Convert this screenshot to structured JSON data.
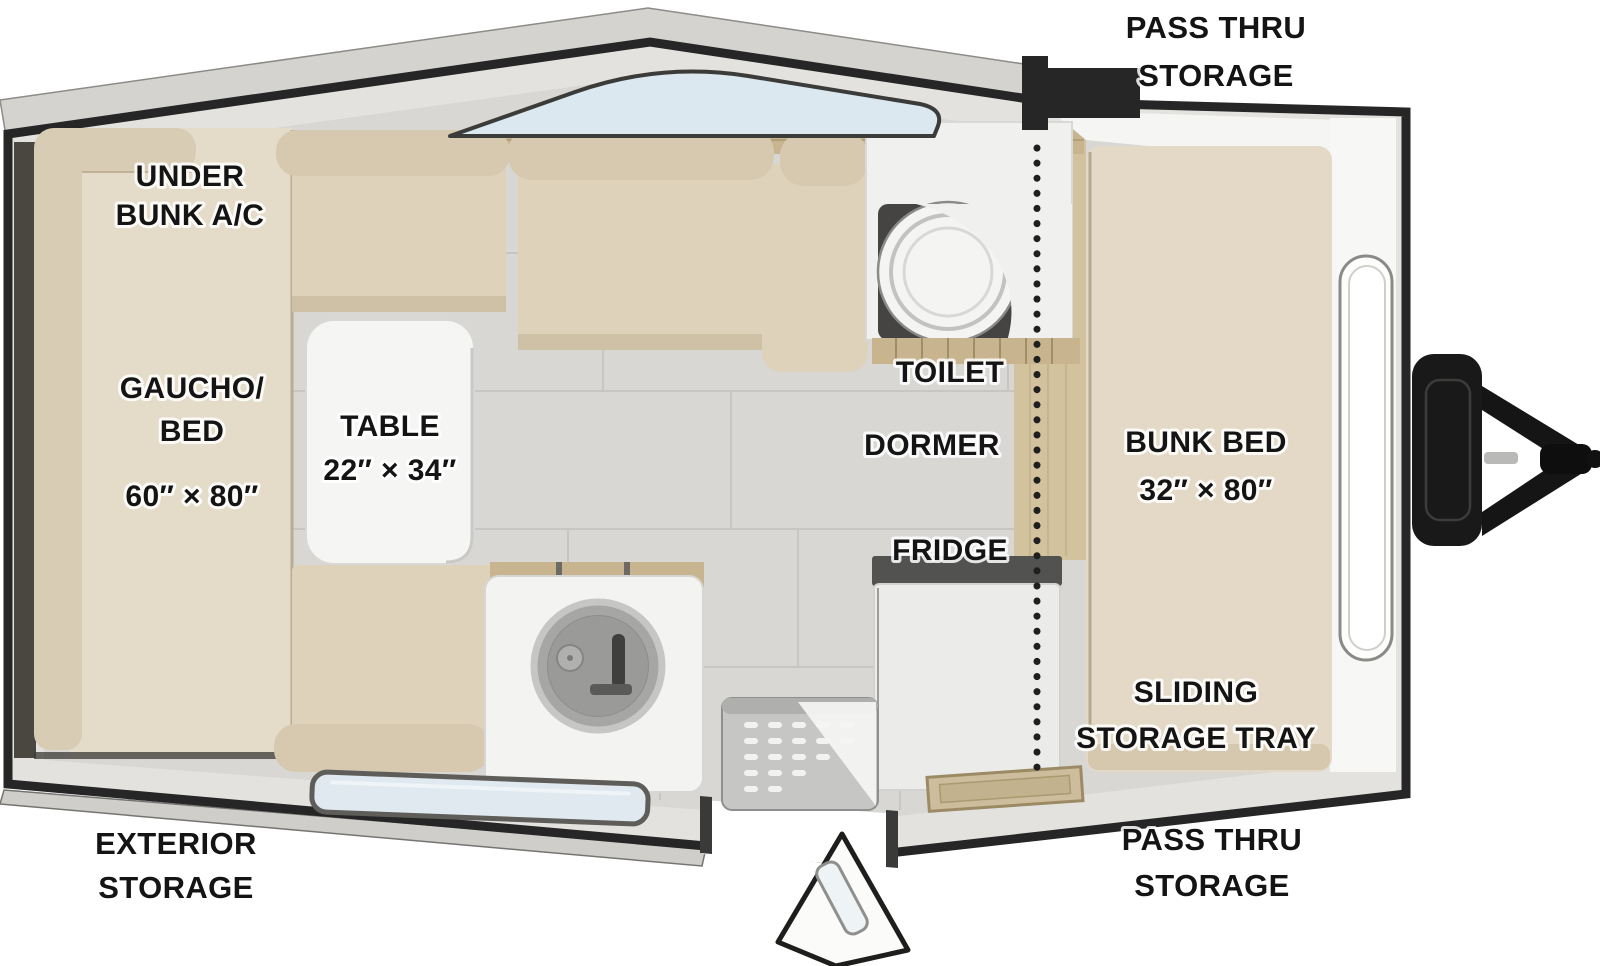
{
  "diagram": {
    "type": "camper-floorplan-top-view",
    "labels": {
      "pass_thru_storage_top": {
        "lines": [
          "PASS THRU",
          "STORAGE"
        ]
      },
      "under_bunk_ac": {
        "lines": [
          "UNDER",
          "BUNK A/C"
        ]
      },
      "gaucho_bed": {
        "lines": [
          "GAUCHO/",
          "BED",
          "60″ × 80″"
        ]
      },
      "table": {
        "lines": [
          "TABLE",
          "22″ × 34″"
        ]
      },
      "toilet": {
        "text": "TOILET"
      },
      "dormer": {
        "text": "DORMER"
      },
      "bunk_bed": {
        "lines": [
          "BUNK BED",
          "32″ × 80″"
        ]
      },
      "fridge": {
        "text": "FRIDGE"
      },
      "sliding_storage_tray": {
        "lines": [
          "SLIDING",
          "STORAGE TRAY"
        ]
      },
      "exterior_storage": {
        "lines": [
          "EXTERIOR",
          "STORAGE"
        ]
      },
      "pass_thru_storage_bottom": {
        "lines": [
          "PASS THRU",
          "STORAGE"
        ]
      }
    },
    "colors": {
      "wall_outline": "#262626",
      "roof_band": "#d4d3cf",
      "wall_fill": "#e3e2de",
      "floor_tile": "#d8d7d3",
      "tile_seam": "#c7c6c2",
      "cushion": "#ded2bb",
      "bolster": "#d6c9b0",
      "gaucho_platform": "#e4dbc9",
      "wood": "#c8b58f",
      "cabinet_white": "#f2f2f1",
      "window_glass": "#dce8ef",
      "label_text": "#141414"
    }
  }
}
